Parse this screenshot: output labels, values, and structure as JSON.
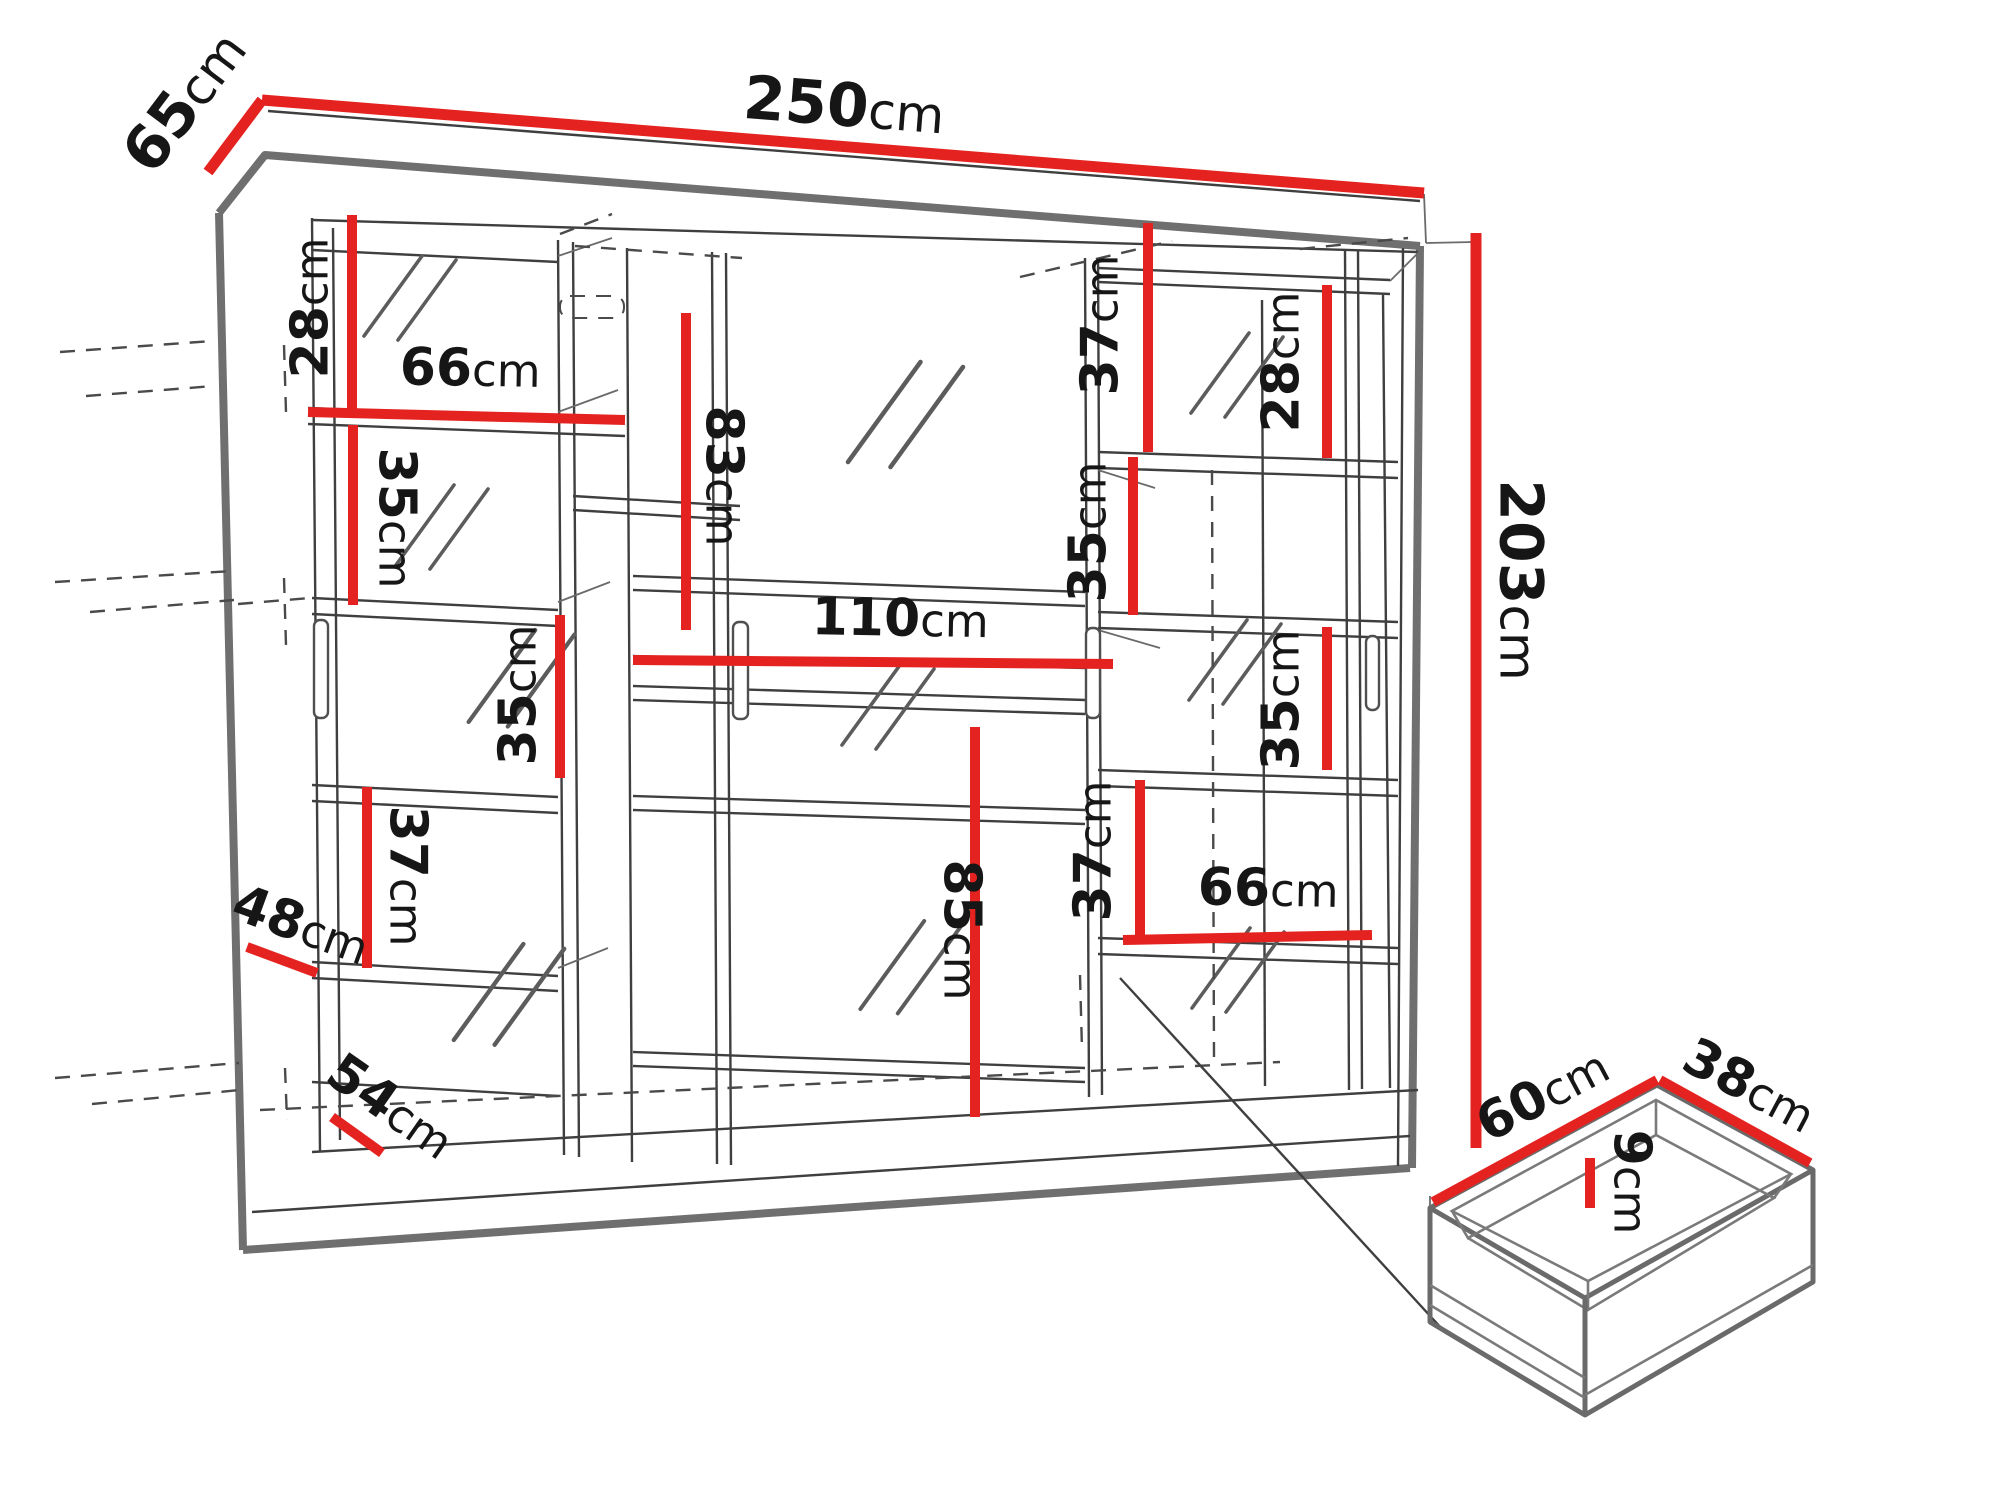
{
  "colors": {
    "dimension_line_red": "#e42320",
    "drawing_line_dark": "#3f3f3f",
    "drawing_edge_gray": "#6f6f6f",
    "label_text": "#161616",
    "background": "#ffffff"
  },
  "dims": {
    "width250": {
      "value": "250",
      "unit": "cm"
    },
    "depth65": {
      "value": "65",
      "unit": "cm"
    },
    "height203": {
      "value": "203",
      "unit": "cm"
    },
    "left28": {
      "value": "28",
      "unit": "cm"
    },
    "left66": {
      "value": "66",
      "unit": "cm"
    },
    "left35a": {
      "value": "35",
      "unit": "cm"
    },
    "left35b": {
      "value": "35",
      "unit": "cm"
    },
    "left37": {
      "value": "37",
      "unit": "cm"
    },
    "depth48": {
      "value": "48",
      "unit": "cm"
    },
    "width54": {
      "value": "54",
      "unit": "cm"
    },
    "mid83": {
      "value": "83",
      "unit": "cm"
    },
    "mid110": {
      "value": "110",
      "unit": "cm"
    },
    "mid85": {
      "value": "85",
      "unit": "cm"
    },
    "right37top": {
      "value": "37",
      "unit": "cm"
    },
    "right28": {
      "value": "28",
      "unit": "cm"
    },
    "right35a": {
      "value": "35",
      "unit": "cm"
    },
    "right35b": {
      "value": "35",
      "unit": "cm"
    },
    "right37low": {
      "value": "37",
      "unit": "cm"
    },
    "right66": {
      "value": "66",
      "unit": "cm"
    },
    "drawer60": {
      "value": "60",
      "unit": "cm"
    },
    "drawer38": {
      "value": "38",
      "unit": "cm"
    },
    "drawer9": {
      "value": "9",
      "unit": "cm"
    }
  }
}
